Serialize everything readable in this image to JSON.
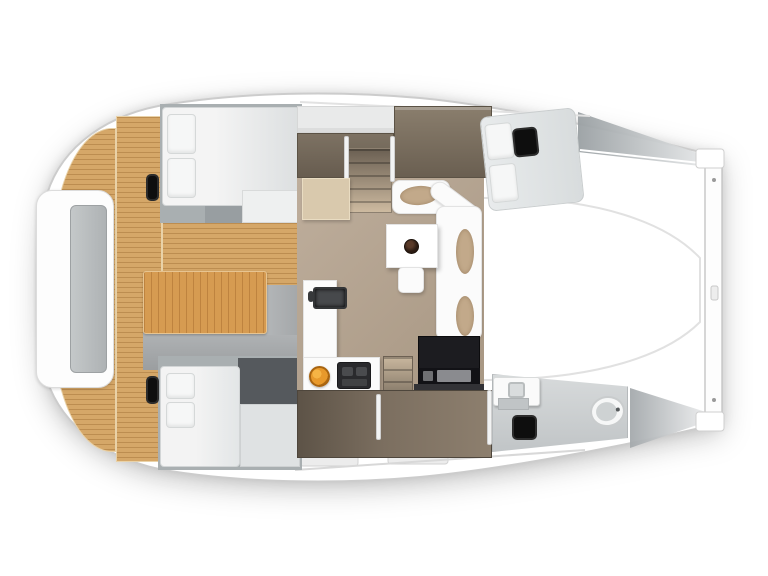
{
  "title": "Catamaran interior floor plan (overhead cutaway view)",
  "vessel": {
    "type": "sailing catamaran floor plan render",
    "view": "top-down",
    "orientation": {
      "bow": "right",
      "stern": "left"
    }
  },
  "palette": {
    "background": "#ffffff",
    "hull_fill": "#ffffff",
    "hull_outline": "#cccccc",
    "teak_deck": "#d5a768",
    "teak_seam": "#b9884a",
    "cockpit_table_wood": "#d69b51",
    "salon_floor": "#b2a190",
    "joinery_dark_taupe": "#6f6456",
    "stair_wood": "#c3b098",
    "landing_wood": "#d9c9ad",
    "settee_white": "#fbfbfb",
    "cushion_tan": "#c2a98a",
    "mattress_white": "#f2f2f2",
    "mattress_grey": "#d7dadb",
    "hatch_black": "#0e0e0e",
    "appliance_black": "#1d1d20",
    "sink_grey": "#47494c",
    "fruit_orange": "#e8992b",
    "wet_floor_grey": "#ccd0d1",
    "platform_grey": "#a6a9ab",
    "alcove_grey": "#a9afb1"
  },
  "areas": {
    "aft_cockpit": {
      "name": "aft cockpit",
      "features": [
        "teak deck",
        "transom bench with grey pad",
        "wooden cockpit table",
        "entry platform"
      ]
    },
    "salon": {
      "name": "bridgedeck salon",
      "features": [
        "square dinette table with dark bowl",
        "L-shaped settee with tan cushions",
        "stool",
        "galley counter with sink and faucet",
        "two-burner cooktop",
        "bowl of oranges",
        "black electronics cabinet"
      ]
    },
    "port_hull": {
      "name": "port hull (top)",
      "features": [
        "aft double berth with two pillows",
        "teak-side deck hatch",
        "overhead lockers",
        "dark wardrobe joinery",
        "companionway stairs with landing",
        "forward double berth with two pillows",
        "cabin ceiling hatch"
      ]
    },
    "starboard_hull": {
      "name": "starboard hull (bottom)",
      "features": [
        "aft double berth with two pillows",
        "teak-side deck hatch",
        "companionway stairs",
        "dark wardrobe joinery",
        "forward head: vanity sink, floor hatch, toilet"
      ]
    },
    "foredeck": {
      "name": "foredeck / trampoline",
      "features": [
        "white trampoline panel",
        "forward crossbeam with end fittings"
      ]
    }
  },
  "fixtures": [
    "transom-bench",
    "cockpit-table",
    "port-aft-berth",
    "starboard-aft-berth",
    "port-forward-berth",
    "deck-hatch-port",
    "deck-hatch-starboard",
    "cabin-hatch-port-forward",
    "head-floor-hatch",
    "dinette-table",
    "table-bowl",
    "settee",
    "stool",
    "galley-sink",
    "cooktop",
    "fruit-bowl",
    "electronics-cabinet",
    "vanity-sink",
    "toilet",
    "companionway-stairs-port",
    "companionway-stairs-starboard",
    "crossbeam"
  ]
}
